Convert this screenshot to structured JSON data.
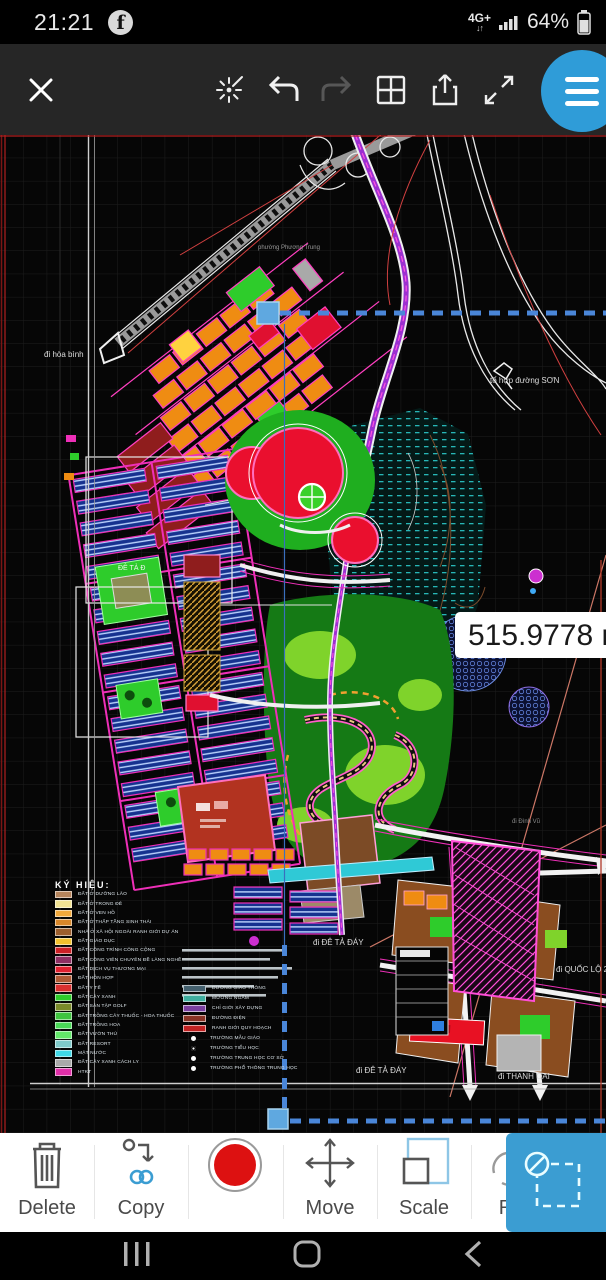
{
  "status_bar": {
    "time": "21:21",
    "network": "4G+",
    "battery_percent": "64%"
  },
  "toolbar": {
    "icons": [
      "close-icon",
      "snap-icon",
      "undo-icon",
      "redo-icon",
      "split-view-icon",
      "share-icon",
      "fullscreen-icon",
      "menu-icon"
    ]
  },
  "measurement": {
    "value": "515.9778 m"
  },
  "map": {
    "labels": [
      {
        "text": "đi hòa bình",
        "x": 44,
        "y": 215,
        "size": 8,
        "color": "#dcdcdc"
      },
      {
        "text": "phường Phương Trung",
        "x": 258,
        "y": 110,
        "size": 6,
        "color": "#9a9a9a"
      },
      {
        "text": "tổ hợp đường SƠN",
        "x": 490,
        "y": 241,
        "size": 8,
        "color": "#dcdcdc"
      },
      {
        "text": "ĐÊ TẢ Đ",
        "x": 118,
        "y": 430,
        "size": 7,
        "color": "#eef4ee"
      },
      {
        "text": "đi Đình Vũ",
        "x": 512,
        "y": 684,
        "size": 6,
        "color": "#8a8a8a"
      },
      {
        "text": "đi ĐÊ TẢ ĐÁY",
        "x": 313,
        "y": 803,
        "size": 8,
        "color": "#dcdcdc"
      },
      {
        "text": "đi QUỐC LỘ 2",
        "x": 556,
        "y": 830,
        "size": 8,
        "color": "#dcdcdc"
      },
      {
        "text": "đi ĐÊ TẢ ĐÁY",
        "x": 356,
        "y": 931,
        "size": 8,
        "color": "#dcdcdc"
      },
      {
        "text": "đi THANH OAI",
        "x": 498,
        "y": 937,
        "size": 8,
        "color": "#dcdcdc"
      }
    ],
    "legend": {
      "title": "KÝ HIỆU:",
      "land_use": [
        {
          "label": "ĐẤT Ở DƯỠNG LÃO",
          "color": "#b5845c"
        },
        {
          "label": "ĐẤT Ở TRONG ĐÊ",
          "color": "#f2e394"
        },
        {
          "label": "ĐẤT Ở VEN HỒ",
          "color": "#f2a93b"
        },
        {
          "label": "ĐẤT Ở THẤP TẦNG SINH THÁI",
          "color": "#d8872a"
        },
        {
          "label": "NHÀ Ở XÃ HỘI NGOÀI RANH GIỚI DỰ ÁN",
          "color": "#9c5f2e"
        },
        {
          "label": "ĐẤT GIÁO DỤC",
          "color": "#f2c12e"
        },
        {
          "label": "ĐẤT CÔNG TRÌNH CÔNG CỘNG",
          "color": "#cc2026"
        },
        {
          "label": "ĐẤT CÔNG VIÊN CHUYÊN ĐỀ LÀNG NGHỀ",
          "color": "#8e2f63"
        },
        {
          "label": "ĐẤT DỊCH VỤ THƯƠNG MẠI",
          "color": "#e02030"
        },
        {
          "label": "ĐẤT HỖN HỢP",
          "color": "#b05a35"
        },
        {
          "label": "ĐẤT Y TẾ",
          "color": "#d93030"
        },
        {
          "label": "ĐẤT CÂY XANH",
          "color": "#2ecc2b"
        },
        {
          "label": "ĐẤT SÂN TẬP GOLF",
          "color": "#7a8a2a"
        },
        {
          "label": "ĐẤT TRỒNG CÂY THUỐC - HOA THUỐC",
          "color": "#3fc43f"
        },
        {
          "label": "ĐẤT TRỒNG HOA",
          "color": "#49d957"
        },
        {
          "label": "ĐẤT VƯỜN THÚ",
          "color": "#63e86a"
        },
        {
          "label": "ĐẤT RESORT",
          "color": "#7fc9c9"
        },
        {
          "label": "MẶT NƯỚC",
          "color": "#3fd9e8"
        },
        {
          "label": "ĐẤT CÂY XANH CÁCH LY",
          "color": "#a9a9a9"
        },
        {
          "label": "HTKT",
          "color": "#e02fa9"
        }
      ],
      "lines": [
        {
          "label": "ĐƯỜNG GIAO THÔNG",
          "color": "#44606e"
        },
        {
          "label": "MƯƠNG NGẦM",
          "color": "#3fae9f"
        },
        {
          "label": "CHỈ GIỚI XÂY DỰNG",
          "color": "#7a3fa0"
        },
        {
          "label": "ĐƯỜNG ĐIỆN",
          "color": "#8a3326"
        },
        {
          "label": "RANH GIỚI QUY HOẠCH",
          "color": "#c22222"
        }
      ],
      "points": [
        {
          "label": "TRƯỜNG MẪU GIÁO",
          "style": "dot"
        },
        {
          "label": "TRƯỜNG TIỂU HỌC",
          "style": "ring"
        },
        {
          "label": "TRƯỜNG TRUNG HỌC CƠ SỞ",
          "style": "dot"
        },
        {
          "label": "TRƯỜNG PHỔ THÔNG TRUNG HỌC",
          "style": "dot"
        }
      ]
    }
  },
  "bottom_toolbar": {
    "items": [
      {
        "icon": "trash-icon",
        "label": "Delete"
      },
      {
        "icon": "copy-icon",
        "label": "Copy"
      },
      {
        "icon": "record-icon",
        "label": ""
      },
      {
        "icon": "move-icon",
        "label": "Move"
      },
      {
        "icon": "scale-icon",
        "label": "Scale"
      },
      {
        "icon": "rotate-icon",
        "label": "R"
      }
    ],
    "selection_panel_icon": "deselect-icon"
  },
  "nav_bar": {
    "icons": [
      "recents-icon",
      "home-icon",
      "back-icon"
    ]
  },
  "colors": {
    "accent_blue": "#2f9cd8",
    "panel_blue": "#3b9dd2",
    "record_red": "#dd1111",
    "selection_blue": "#4a86d8"
  }
}
